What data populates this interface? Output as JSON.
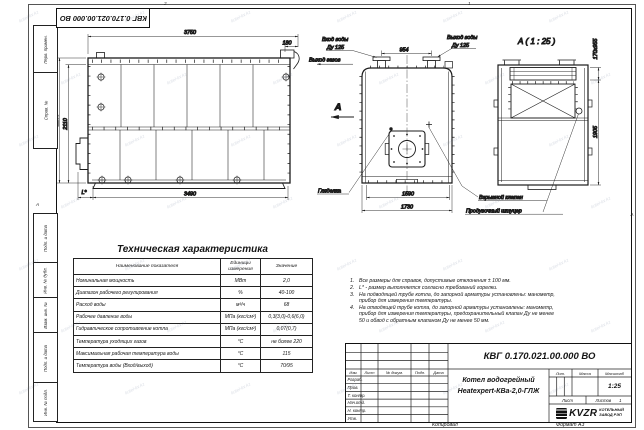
{
  "watermark": "kotel-kv.kz",
  "stamp": {
    "code": "КВГ 0.170.021.00.000 ВО"
  },
  "margin": {
    "top_labels": [
      "Перв. примен.",
      "Справ. №"
    ],
    "bottom_labels": [
      "Подп. и дата",
      "Инв. № дубл.",
      "Взам. инв. №",
      "Подп. и дата",
      "Инв. № подл."
    ],
    "zone_top_left": "2",
    "zone_top_right": "1",
    "zone_left": "А",
    "zone_right": "А"
  },
  "side_view": {
    "dim_top": "3750",
    "dim_offset": "180",
    "dim_height_outer": "2230",
    "dim_height_inner": "2110",
    "dim_bottom": "3490",
    "dim_l": "L*"
  },
  "front_view": {
    "label_inlet_1": "Вход воды",
    "label_inlet_2": "Ду 125",
    "label_outlet_1": "Выход воды",
    "label_outlet_2": "Ду 125",
    "label_gas": "Выход газов",
    "label_sight": "Гляделка",
    "section_letter": "А",
    "dim_nozzles": "954",
    "dim_inner": "1590",
    "dim_outer": "1730"
  },
  "a_view": {
    "title": "А ( 1 : 25 )",
    "dim_slot": "170x955",
    "dim_height": "1905",
    "label_valve": "Взрывной клапан",
    "label_fitting": "Продувочный штуцер"
  },
  "table": {
    "title": "Техническая характеристика",
    "col_headers": [
      "Наименование показателя",
      "Единицы измерения",
      "Значение"
    ],
    "rows": [
      [
        "Номинальная мощность",
        "МВт",
        "2,0"
      ],
      [
        "Диапазон рабочего регулирования",
        "%",
        "40-100"
      ],
      [
        "Расход воды",
        "м³/ч",
        "68"
      ],
      [
        "Рабочее давление воды",
        "МПа (кгс/см²)",
        "0,3(3,0)-0,6(6,0)"
      ],
      [
        "Гидравлическое сопротивление котла",
        "МПа (кгс/см²)",
        "0,07(0,7)"
      ],
      [
        "Температура уходящих газов",
        "°С",
        "не более 220"
      ],
      [
        "Максимальная рабочая температура воды",
        "°С",
        "115"
      ],
      [
        "Температура воды (Вход/выход)",
        "°С",
        "70/95"
      ]
    ]
  },
  "notes": {
    "items": [
      {
        "n": "1.",
        "text": "Все размеры для справок, допустимые отклонения ± 100 мм."
      },
      {
        "n": "2.",
        "text": "L* - размер выполняется согласно требований горелки."
      },
      {
        "n": "3.",
        "text": "На подводящей трубе котла, до запорной арматуры установлены: манометр, прибор для измерения температуры."
      },
      {
        "n": "4.",
        "text": "На отводящей трубе котла, до запорной арматуры установлены: манометр, прибор для измерения температуры, предохранительный клапан Ду не менее 50 и обвод с обратным клапаном Ду не менее 50 мм."
      }
    ]
  },
  "title_block": {
    "designation": "КВГ 0.170.021.00.000 ВО",
    "product_name_1": "Котел водогрейный",
    "product_name_2": "Heatexpert-КВа-2,0-ГЛЖ",
    "header_cols": [
      "Изм.",
      "Лист",
      "№ докум.",
      "Подп.",
      "Дата"
    ],
    "row_labels": [
      "Разраб.",
      "Пров.",
      "Т. контр.",
      "Нач.отд.",
      "Н. контр.",
      "Утв."
    ],
    "lit_label": "Лит.",
    "mass_label": "Масса",
    "scale_label": "Масштаб",
    "scale_value": "1:25",
    "sheet_label": "Лист",
    "sheets_label": "Листов",
    "sheets_value": "1",
    "logo_text": "KVZR",
    "company_line_1": "КОТЕЛЬНЫЙ",
    "company_line_2": "ЗАВОД РЭП",
    "copied_label": "Копировал",
    "format_label": "Формат А3"
  }
}
